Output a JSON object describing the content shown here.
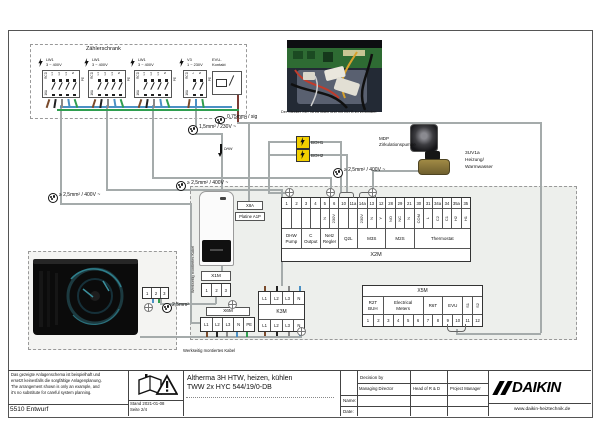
{
  "zaehlerschrank": {
    "label": "Zählerschrank",
    "groups": [
      {
        "name": "LW1",
        "voltage": "3 ~ 400V",
        "rcd": "RCD",
        "amps": "16A",
        "terminals": [
          "L1",
          "L2",
          "L3",
          "N"
        ],
        "pe": "PE"
      },
      {
        "name": "LW1",
        "voltage": "3 ~ 400V",
        "rcd": "RCD",
        "amps": "16A",
        "terminals": [
          "L1",
          "L2",
          "L3",
          "N"
        ],
        "pe": "PE"
      },
      {
        "name": "LW1",
        "voltage": "3 ~ 400V",
        "rcd": "RCD",
        "amps": "16A",
        "terminals": [
          "L1",
          "L2",
          "L3",
          "N"
        ],
        "pe": "PE"
      },
      {
        "name": "V3",
        "voltage": "1 ~ 230V",
        "rcd": "RCD",
        "amps": "16A",
        "terminals": [
          "L",
          "N"
        ],
        "pe": "PE"
      }
    ],
    "evu_label": "EVU-\nKontakt"
  },
  "photo": {
    "caption": "Der Stecker X6Y ist zu lösen und mit X6YB zu verbinden"
  },
  "cables": {
    "sig": "0,75mm² / sig",
    "c230": "1,5mm² / 230V ~",
    "c400": [
      "≥ 2,5mm² / 400V ~",
      "≥ 2,5mm² / 400V ~",
      "≥ 2,5mm² / 400V ~"
    ],
    "c25": "2,5mm²",
    "dhw": "DHW"
  },
  "components": {
    "boh1": "BOH1",
    "boh2": "BOH2",
    "mdp1": "MDP",
    "mdp2": "Zirkulationspumpe",
    "valve1": "3UV1a",
    "valve2": "Heizung/",
    "valve3": "Warmwasser",
    "x8a": "X8A",
    "platine": "Platine A1P",
    "factory_cable_v": "Werkseitig montiertes Kabel",
    "factory_cable_h": "Werkseitig montiertes Kabel"
  },
  "x2m": {
    "label": "X2M",
    "columns": [
      {
        "n": "1",
        "s": ""
      },
      {
        "n": "2",
        "s": ""
      },
      {
        "n": "3",
        "s": ""
      },
      {
        "n": "4",
        "s": ""
      },
      {
        "n": "5",
        "s": "N"
      },
      {
        "n": "6",
        "s": "230V"
      },
      {
        "n": "10",
        "s": ""
      },
      {
        "n": "11a",
        "s": ""
      },
      {
        "n": "14a",
        "s": "230V"
      },
      {
        "n": "13",
        "s": "N"
      },
      {
        "n": "12",
        "s": "Y"
      },
      {
        "n": "28",
        "s": "NO"
      },
      {
        "n": "29",
        "s": "NC"
      },
      {
        "n": "21",
        "s": "N"
      },
      {
        "n": "30",
        "s": "COM"
      },
      {
        "n": "31",
        "s": "L"
      },
      {
        "n": "34a",
        "s": "C2"
      },
      {
        "n": "34",
        "s": "C1"
      },
      {
        "n": "35a",
        "s": "H2"
      },
      {
        "n": "35",
        "s": "H1"
      }
    ],
    "groups": [
      {
        "label": "DHW\nPump",
        "span": 2
      },
      {
        "label": "C\nOutput",
        "span": 2
      },
      {
        "label": "Netz\nRegler",
        "span": 2
      },
      {
        "label": "Q2L",
        "span": 2
      },
      {
        "label": "M3S",
        "span": 3
      },
      {
        "label": "M2S",
        "span": 3
      },
      {
        "label": "Thermostat",
        "span": 6
      }
    ]
  },
  "x5m": {
    "label": "X5M",
    "groups": [
      {
        "label": "R2T\nBUH",
        "span": 2
      },
      {
        "label": "Electrical\nMeters",
        "span": 4
      },
      {
        "label": "R6T",
        "span": 2
      },
      {
        "label": "EVU",
        "span": 2
      },
      {
        "label": "S1",
        "span": 1,
        "rot": true
      },
      {
        "label": "S2",
        "span": 1,
        "rot": true
      }
    ],
    "numbers": [
      "1",
      "2",
      "3",
      "4",
      "5",
      "6",
      "7",
      "8",
      "9",
      "10",
      "11",
      "12"
    ]
  },
  "x1m": {
    "label": "X1M",
    "terminals": [
      "1",
      "2",
      "3"
    ]
  },
  "k3m": {
    "label": "K3M",
    "top": [
      "L1",
      "L2",
      "L3",
      "N"
    ],
    "bottom": [
      "L1",
      "L2",
      "L3",
      "N"
    ]
  },
  "x6m": {
    "label": "X6M",
    "terminals": [
      "L1",
      "L2",
      "L3",
      "N",
      "PE"
    ]
  },
  "outdoor": {
    "terminals": [
      "1",
      "2",
      "3"
    ]
  },
  "titleblock": {
    "disclaimer": [
      "Das gezeigte Anlagenschema ist beispielhaft und",
      "ersetzt keinesfalls die sorgfältige Anlagenplanung.",
      "The arrangement shown is only an example, and",
      "it's no substitute for careful system planning."
    ],
    "doc_number": "5510 Entwurf",
    "stand": "Stand 2021-01-08",
    "page": "Seite 2/4",
    "title_line1": "Altherma 3H HTW, heizen, kühlen",
    "title_line2": "TWW 2x HYC 544/19/0-DB",
    "decision_by": "Decision by",
    "roles": [
      "Managing Director",
      "Head of R & D",
      "Project Manager"
    ],
    "name_label": "Name:",
    "date_label": "Date:",
    "brand": "DAIKIN",
    "website": "www.daikin-heiztechnik.de"
  }
}
